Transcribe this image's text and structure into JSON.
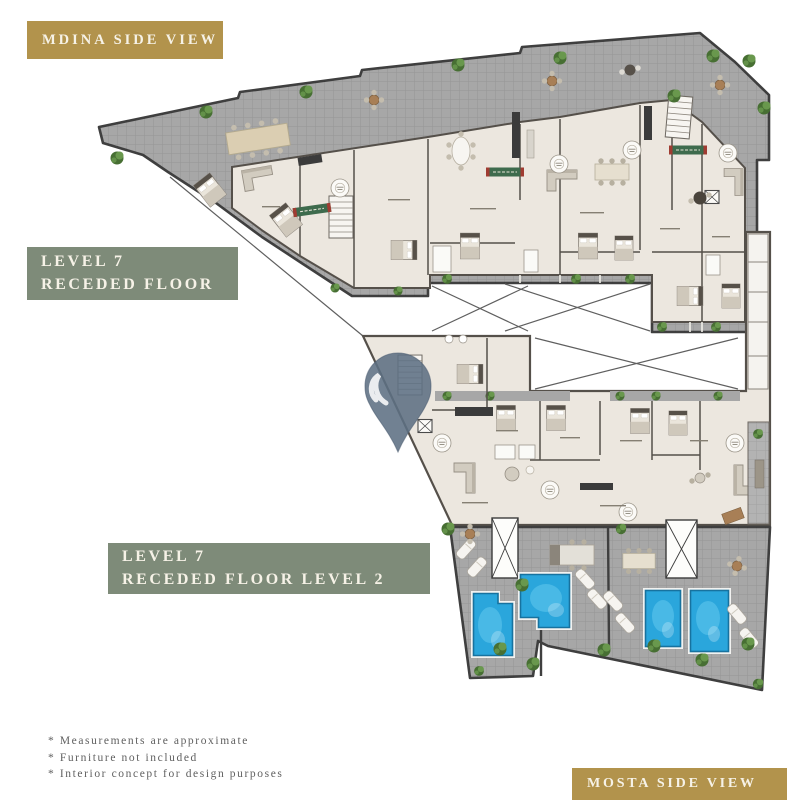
{
  "page": {
    "width": 800,
    "height": 800
  },
  "badges": {
    "mdina": {
      "label": "MDINA SIDE VIEW"
    },
    "level7_upper": {
      "line1": "LEVEL 7",
      "line2": "RECEDED FLOOR"
    },
    "level7_lower": {
      "line1": "LEVEL 7",
      "line2": "RECEDED FLOOR LEVEL 2"
    },
    "mosta": {
      "label": "MOSTA SIDE VIEW"
    }
  },
  "disclaimers": {
    "items": [
      "* Measurements are approximate",
      "* Furniture not included",
      "* Interior concept for design purposes"
    ]
  },
  "watermark": {
    "name": "location-pin"
  },
  "colors": {
    "page_bg": "#ffffff",
    "gold": "#b2934c",
    "sage": "#7e8b79",
    "badge_text": "#f6f2e7",
    "disclaimer_text": "#5f5f5f",
    "terrace": "#a7a7a7",
    "wall": "#3f3f3f",
    "interior": "#ece7df",
    "interior_wall": "#55504a",
    "pool": "#2aa6dc",
    "pool_light": "#67cbf0",
    "plant_dark": "#476f33",
    "plant_light": "#69984d",
    "pin": "#5d7083",
    "banner_green": "#3e6b4d",
    "banner_red": "#a03c32",
    "wood": "#a87f56"
  }
}
